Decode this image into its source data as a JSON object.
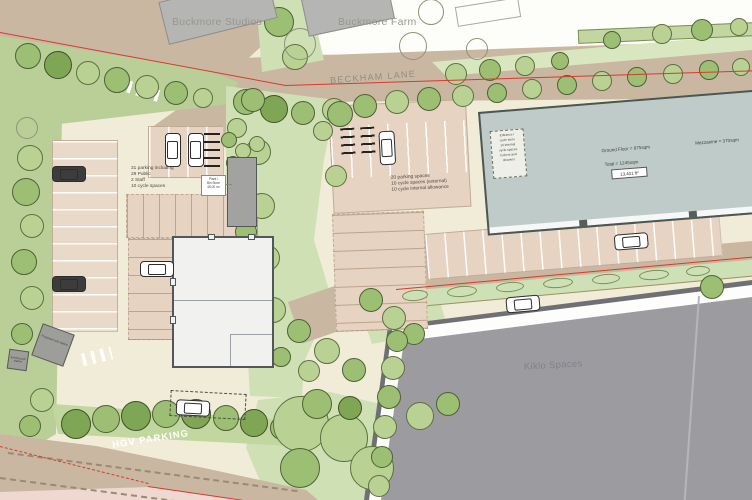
{
  "labels": {
    "buckmore_studios": "Buckmore Studios",
    "buckmore_farm": "Buckmore Farm",
    "beckham_lane": "BECKHAM LANE",
    "kiklo_spaces": "Kiklo Spaces",
    "hgv_parking": "HGV PARKING"
  },
  "annotations": {
    "west_parking_lines": [
      "31 parking including",
      "29 Public",
      "2 Staff",
      "10 cycle spaces"
    ],
    "central_parking_lines": [
      "20 parking spaces",
      "10 cycle spaces (external)",
      "10 cycle internal allowance"
    ],
    "plant_store_lines": [
      "Plant /",
      "Bin Store",
      "45.00 m²"
    ],
    "unit_ground": "Ground Floor = 875sqm",
    "unit_mezzanine": "Mezzanine = 370sqm",
    "unit_total": "Total = 1245sqm",
    "unit_total_box": "13,401 ft²",
    "unit_note_lines": [
      "Entrance /",
      "cycle store",
      "10 internal",
      "cycle spaces",
      "lockers and",
      "showers"
    ],
    "substation_proposed": "Proposed sub station",
    "substation_existing": "Existing sub station"
  },
  "colors": {
    "site_boundary_red": "#d73a2c",
    "road_tan": "#c9b7a2",
    "parking_pink": "#e6d3c2",
    "ground_cream": "#f1ecd8",
    "green_light": "#cfe0b4",
    "green_belt": "#b9cf97",
    "tree_mid": "#9cbf74",
    "tree_dark": "#7fa654",
    "unit_building_fill": "#f1f1ef",
    "industrial_building_fill": "#bfcbc8",
    "kiklo_building_fill": "#9c9ca0",
    "context_building_fill": "#b5b5b3"
  }
}
